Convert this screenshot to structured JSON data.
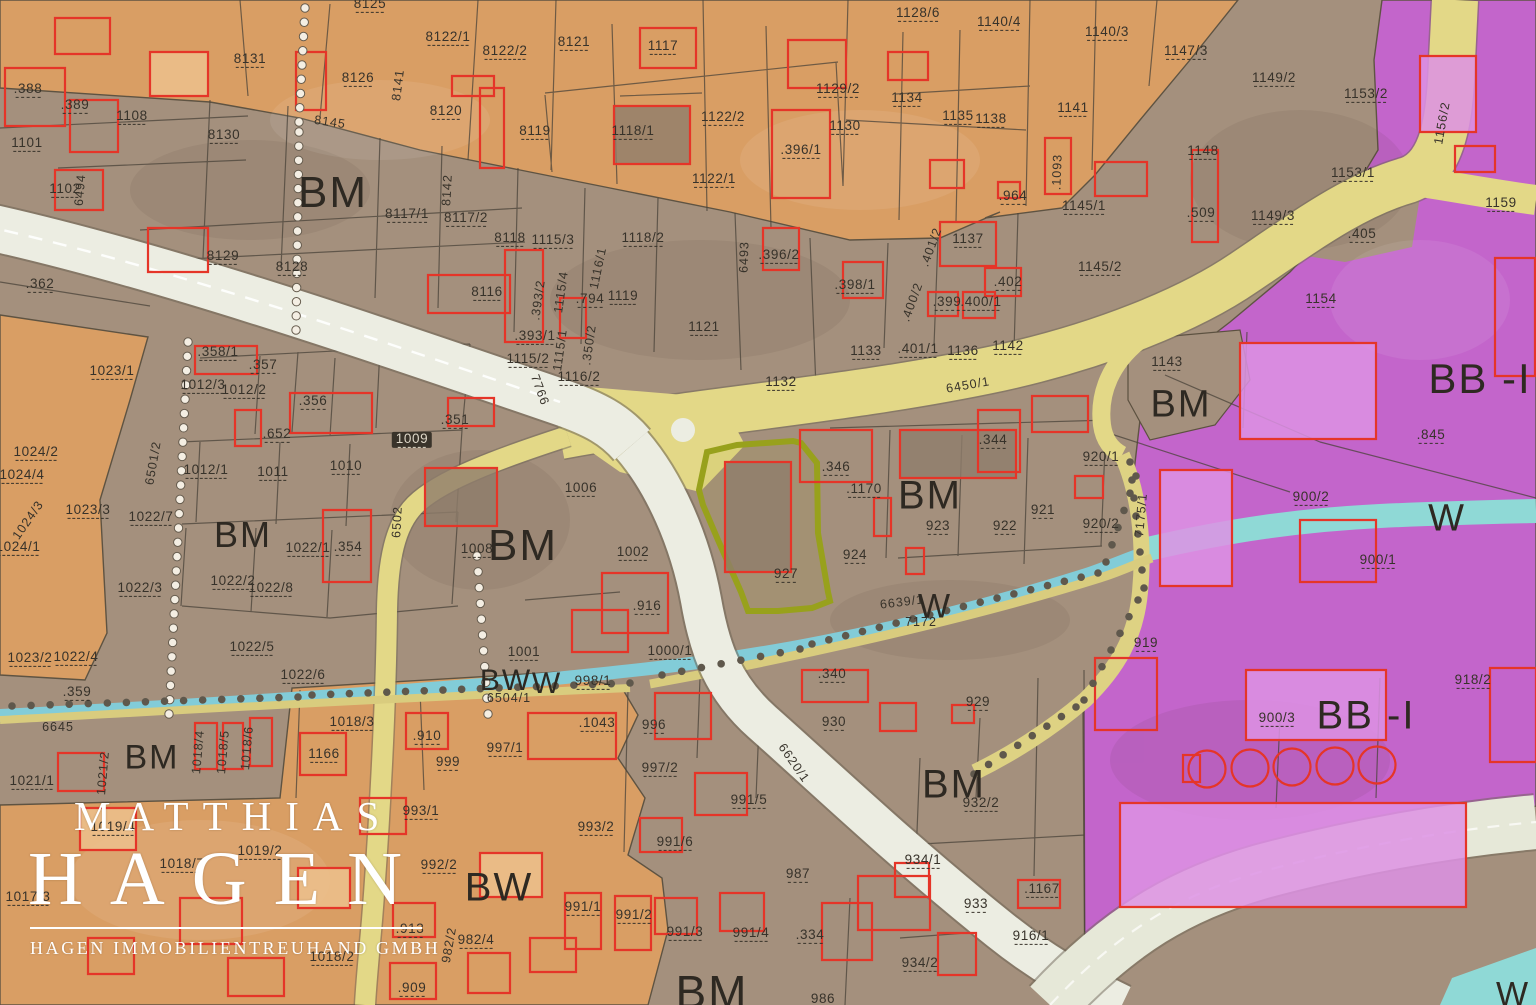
{
  "map": {
    "type": "zoning-cadastral-map",
    "zone_codes": [
      "BM",
      "BW",
      "W",
      "BB -I"
    ],
    "highlighted_parcel": "927",
    "colors": {
      "zone_mixed_brown": "#a4907d",
      "zone_residential_orange": "#dc9f63",
      "zone_industrial_purple": "#c563d0",
      "road_yellow": "#e3d887",
      "road_white": "#ecede2",
      "stream_blue": "#82ccd8",
      "stream_teal": "#8fd9d6",
      "building_outline_red": "#e53528",
      "highlight_olive": "#98a11c",
      "label_dark": "#37322a",
      "watermark_white": "#ffffff"
    }
  },
  "watermark": {
    "line1": "MATTHIAS",
    "line2": "HAGEN",
    "line3": "HAGEN IMMOBILIENTREUHAND GMBH"
  },
  "labels": {
    "zones": [
      {
        "t": "BM",
        "x": 333,
        "y": 193,
        "s": 44
      },
      {
        "t": "BM",
        "x": 243,
        "y": 535,
        "s": 36
      },
      {
        "t": "BM",
        "x": 523,
        "y": 546,
        "s": 44
      },
      {
        "t": "BM",
        "x": 930,
        "y": 496,
        "s": 40
      },
      {
        "t": "BM",
        "x": 1181,
        "y": 405,
        "s": 38
      },
      {
        "t": "BM",
        "x": 152,
        "y": 758,
        "s": 34
      },
      {
        "t": "BM",
        "x": 954,
        "y": 785,
        "s": 40
      },
      {
        "t": "BM",
        "x": 712,
        "y": 992,
        "s": 46
      },
      {
        "t": "BB -I",
        "x": 1480,
        "y": 379,
        "s": 42
      },
      {
        "t": "BB -I",
        "x": 1366,
        "y": 716,
        "s": 40
      },
      {
        "t": "BW",
        "x": 499,
        "y": 888,
        "s": 40
      },
      {
        "t": "BW",
        "x": 506,
        "y": 681,
        "s": 30
      },
      {
        "t": "W",
        "x": 547,
        "y": 684,
        "s": 30
      },
      {
        "t": "W",
        "x": 935,
        "y": 607,
        "s": 34
      },
      {
        "t": "W",
        "x": 1447,
        "y": 519,
        "s": 38
      },
      {
        "t": "W",
        "x": 1513,
        "y": 995,
        "s": 34
      }
    ],
    "parcels": [
      {
        "t": ".388",
        "x": 28,
        "y": 90
      },
      {
        "t": ".389",
        "x": 75,
        "y": 106
      },
      {
        "t": "1101",
        "x": 27,
        "y": 144
      },
      {
        "t": "1108",
        "x": 132,
        "y": 117
      },
      {
        "t": "8131",
        "x": 250,
        "y": 60
      },
      {
        "t": "8126",
        "x": 358,
        "y": 79
      },
      {
        "t": "8125",
        "x": 370,
        "y": 5
      },
      {
        "t": "8120",
        "x": 446,
        "y": 112
      },
      {
        "t": "8130",
        "x": 224,
        "y": 136
      },
      {
        "t": "8119",
        "x": 535,
        "y": 132
      },
      {
        "t": "8121",
        "x": 574,
        "y": 43
      },
      {
        "t": "8122/1",
        "x": 448,
        "y": 38
      },
      {
        "t": "8122/2",
        "x": 505,
        "y": 52
      },
      {
        "t": "1117",
        "x": 663,
        "y": 47
      },
      {
        "t": "1118/1",
        "x": 633,
        "y": 132
      },
      {
        "t": "1122/2",
        "x": 723,
        "y": 118
      },
      {
        "t": "1122/1",
        "x": 714,
        "y": 180
      },
      {
        "t": "1129/2",
        "x": 838,
        "y": 90
      },
      {
        "t": "1130",
        "x": 845,
        "y": 127
      },
      {
        "t": "1134",
        "x": 907,
        "y": 99
      },
      {
        "t": "1135",
        "x": 958,
        "y": 117
      },
      {
        "t": "1138",
        "x": 991,
        "y": 120
      },
      {
        "t": "1141",
        "x": 1073,
        "y": 109
      },
      {
        "t": "1128/6",
        "x": 918,
        "y": 14
      },
      {
        "t": "1140/4",
        "x": 999,
        "y": 23
      },
      {
        "t": "1140/3",
        "x": 1107,
        "y": 33
      },
      {
        "t": "1147/3",
        "x": 1186,
        "y": 52
      },
      {
        "t": "1149/2",
        "x": 1274,
        "y": 79
      },
      {
        "t": "1153/2",
        "x": 1366,
        "y": 95
      },
      {
        "t": "1153/1",
        "x": 1353,
        "y": 174
      },
      {
        "t": ".405",
        "x": 1362,
        "y": 235
      },
      {
        "t": "1148",
        "x": 1203,
        "y": 152
      },
      {
        "t": ".509",
        "x": 1201,
        "y": 214
      },
      {
        "t": "1149/3",
        "x": 1273,
        "y": 217
      },
      {
        "t": "1154",
        "x": 1321,
        "y": 300
      },
      {
        "t": "1159",
        "x": 1501,
        "y": 204
      },
      {
        "t": ".396/1",
        "x": 801,
        "y": 151
      },
      {
        "t": "1102",
        "x": 65,
        "y": 190
      },
      {
        "t": ".362",
        "x": 40,
        "y": 285
      },
      {
        "t": "8129",
        "x": 223,
        "y": 257
      },
      {
        "t": "8128",
        "x": 292,
        "y": 268
      },
      {
        "t": "8117/1",
        "x": 407,
        "y": 215
      },
      {
        "t": "8117/2",
        "x": 466,
        "y": 219
      },
      {
        "t": "8116",
        "x": 487,
        "y": 293
      },
      {
        "t": "8118",
        "x": 510,
        "y": 239
      },
      {
        "t": "1115/3",
        "x": 553,
        "y": 241
      },
      {
        "t": "1118/2",
        "x": 643,
        "y": 239
      },
      {
        "t": ".794",
        "x": 590,
        "y": 300
      },
      {
        "t": "1119",
        "x": 623,
        "y": 297
      },
      {
        "t": ".393/1",
        "x": 535,
        "y": 337
      },
      {
        "t": "1115/2",
        "x": 528,
        "y": 360
      },
      {
        "t": "1116/2",
        "x": 579,
        "y": 378
      },
      {
        "t": "1121",
        "x": 704,
        "y": 328
      },
      {
        "t": ".396/2",
        "x": 779,
        "y": 256
      },
      {
        "t": ".398/1",
        "x": 855,
        "y": 286
      },
      {
        "t": "1137",
        "x": 968,
        "y": 240
      },
      {
        "t": ".402",
        "x": 1008,
        "y": 283
      },
      {
        "t": ".399",
        "x": 947,
        "y": 303
      },
      {
        "t": ".400/1",
        "x": 981,
        "y": 303
      },
      {
        "t": ".401/1",
        "x": 918,
        "y": 350
      },
      {
        "t": "1136",
        "x": 963,
        "y": 352
      },
      {
        "t": "1142",
        "x": 1008,
        "y": 347
      },
      {
        "t": ".964",
        "x": 1013,
        "y": 197
      },
      {
        "t": "1145/1",
        "x": 1084,
        "y": 207
      },
      {
        "t": "1145/2",
        "x": 1100,
        "y": 268
      },
      {
        "t": "1133",
        "x": 866,
        "y": 352
      },
      {
        "t": "1132",
        "x": 781,
        "y": 383
      },
      {
        "t": "1143",
        "x": 1167,
        "y": 363
      },
      {
        "t": ".845",
        "x": 1431,
        "y": 436
      },
      {
        "t": "900/2",
        "x": 1311,
        "y": 498
      },
      {
        "t": "900/1",
        "x": 1378,
        "y": 561
      },
      {
        "t": "918/2",
        "x": 1473,
        "y": 681
      },
      {
        "t": "900/3",
        "x": 1277,
        "y": 719
      },
      {
        "t": "919",
        "x": 1146,
        "y": 644
      },
      {
        "t": "921",
        "x": 1043,
        "y": 511
      },
      {
        "t": "920/1",
        "x": 1101,
        "y": 458
      },
      {
        "t": "920/2",
        "x": 1101,
        "y": 525
      },
      {
        "t": ".344",
        "x": 993,
        "y": 441
      },
      {
        "t": ".346",
        "x": 836,
        "y": 468
      },
      {
        "t": ".1170",
        "x": 864,
        "y": 490
      },
      {
        "t": "923",
        "x": 938,
        "y": 527
      },
      {
        "t": "922",
        "x": 1005,
        "y": 527
      },
      {
        "t": "924",
        "x": 855,
        "y": 556
      },
      {
        "t": "927",
        "x": 786,
        "y": 575
      },
      {
        "t": ".351",
        "x": 455,
        "y": 421
      },
      {
        "t": ".356",
        "x": 313,
        "y": 402
      },
      {
        "t": ".357",
        "x": 263,
        "y": 366
      },
      {
        "t": ".358/1",
        "x": 218,
        "y": 353
      },
      {
        "t": "1012/3",
        "x": 203,
        "y": 386
      },
      {
        "t": "1012/2",
        "x": 244,
        "y": 391
      },
      {
        "t": ".652",
        "x": 277,
        "y": 435
      },
      {
        "t": "1012/1",
        "x": 206,
        "y": 471
      },
      {
        "t": "1011",
        "x": 273,
        "y": 473
      },
      {
        "t": "1010",
        "x": 346,
        "y": 467
      },
      {
        "t": "1009",
        "x": 412,
        "y": 440,
        "p": true
      },
      {
        "t": "1023/1",
        "x": 112,
        "y": 372
      },
      {
        "t": "1024/2",
        "x": 36,
        "y": 453
      },
      {
        "t": "1024/4",
        "x": 22,
        "y": 476
      },
      {
        "t": "1024/1",
        "x": 18,
        "y": 548
      },
      {
        "t": "1023/3",
        "x": 88,
        "y": 511
      },
      {
        "t": "1022/7",
        "x": 151,
        "y": 518
      },
      {
        "t": "1022/3",
        "x": 140,
        "y": 589
      },
      {
        "t": "1023/2",
        "x": 30,
        "y": 659
      },
      {
        "t": "1022/4",
        "x": 76,
        "y": 658
      },
      {
        "t": ".359",
        "x": 77,
        "y": 693
      },
      {
        "t": "1022/1",
        "x": 308,
        "y": 549
      },
      {
        "t": ".354",
        "x": 348,
        "y": 548
      },
      {
        "t": "1022/2",
        "x": 233,
        "y": 582
      },
      {
        "t": "1022/8",
        "x": 271,
        "y": 589
      },
      {
        "t": "1022/5",
        "x": 252,
        "y": 648
      },
      {
        "t": "1022/6",
        "x": 303,
        "y": 676
      },
      {
        "t": "1008",
        "x": 477,
        "y": 550
      },
      {
        "t": "1006",
        "x": 581,
        "y": 489
      },
      {
        "t": "1002",
        "x": 633,
        "y": 553
      },
      {
        "t": ".916",
        "x": 647,
        "y": 607
      },
      {
        "t": "1001",
        "x": 524,
        "y": 653
      },
      {
        "t": "1000/1",
        "x": 670,
        "y": 652
      },
      {
        "t": "998/1",
        "x": 593,
        "y": 682
      },
      {
        "t": "1018/3",
        "x": 352,
        "y": 723
      },
      {
        "t": "1021/1",
        "x": 32,
        "y": 782
      },
      {
        "t": "1166",
        "x": 324,
        "y": 755
      },
      {
        "t": ".910",
        "x": 427,
        "y": 737
      },
      {
        "t": "999",
        "x": 448,
        "y": 763
      },
      {
        "t": "997/1",
        "x": 505,
        "y": 749
      },
      {
        "t": ".1043",
        "x": 597,
        "y": 724
      },
      {
        "t": "996",
        "x": 654,
        "y": 726
      },
      {
        "t": "997/2",
        "x": 660,
        "y": 769
      },
      {
        "t": "991/5",
        "x": 749,
        "y": 801
      },
      {
        "t": "991/6",
        "x": 675,
        "y": 843
      },
      {
        "t": "993/2",
        "x": 596,
        "y": 828
      },
      {
        "t": "993/1",
        "x": 421,
        "y": 812
      },
      {
        "t": "992/2",
        "x": 439,
        "y": 866
      },
      {
        "t": ".913",
        "x": 410,
        "y": 930
      },
      {
        "t": "982/4",
        "x": 476,
        "y": 941
      },
      {
        "t": ".909",
        "x": 412,
        "y": 989
      },
      {
        "t": "1018/2",
        "x": 332,
        "y": 958
      },
      {
        "t": "1019/2",
        "x": 260,
        "y": 852
      },
      {
        "t": "1019/4",
        "x": 113,
        "y": 828
      },
      {
        "t": "1018/7",
        "x": 182,
        "y": 865
      },
      {
        "t": "1017/3",
        "x": 28,
        "y": 898
      },
      {
        "t": "991/1",
        "x": 583,
        "y": 908
      },
      {
        "t": "991/2",
        "x": 634,
        "y": 916
      },
      {
        "t": "991/3",
        "x": 685,
        "y": 933
      },
      {
        "t": "991/4",
        "x": 751,
        "y": 934
      },
      {
        "t": "987",
        "x": 798,
        "y": 875
      },
      {
        "t": ".334",
        "x": 810,
        "y": 936
      },
      {
        "t": ".340",
        "x": 832,
        "y": 675
      },
      {
        "t": "930",
        "x": 834,
        "y": 723
      },
      {
        "t": "929",
        "x": 978,
        "y": 703
      },
      {
        "t": "932/2",
        "x": 981,
        "y": 804
      },
      {
        "t": "934/1",
        "x": 923,
        "y": 861
      },
      {
        "t": "933",
        "x": 976,
        "y": 905
      },
      {
        "t": "934/2",
        "x": 920,
        "y": 964
      },
      {
        "t": "986",
        "x": 823,
        "y": 1000
      },
      {
        "t": ".1167",
        "x": 1042,
        "y": 890
      },
      {
        "t": "916/1",
        "x": 1031,
        "y": 937
      }
    ],
    "roads": [
      {
        "t": "8141",
        "x": 398,
        "y": 85,
        "r": -83
      },
      {
        "t": "8142",
        "x": 447,
        "y": 190,
        "r": -87
      },
      {
        "t": "8145",
        "x": 330,
        "y": 122,
        "r": 8
      },
      {
        "t": "6494",
        "x": 80,
        "y": 190,
        "r": -85
      },
      {
        "t": "6493",
        "x": 744,
        "y": 257,
        "r": -88
      },
      {
        "t": "7766",
        "x": 540,
        "y": 390,
        "r": 70
      },
      {
        "t": "6502",
        "x": 397,
        "y": 522,
        "r": -87
      },
      {
        "t": "6501/2",
        "x": 153,
        "y": 463,
        "r": -80
      },
      {
        "t": "6450/1",
        "x": 968,
        "y": 385,
        "r": -10
      },
      {
        "t": "6639/1",
        "x": 902,
        "y": 602,
        "r": -7
      },
      {
        "t": "6620/1",
        "x": 794,
        "y": 763,
        "r": 55
      },
      {
        "t": "6645",
        "x": 58,
        "y": 727,
        "r": 0
      },
      {
        "t": "6504/1",
        "x": 509,
        "y": 698,
        "r": 0
      },
      {
        "t": "1156/2",
        "x": 1442,
        "y": 123,
        "r": -80
      },
      {
        "t": "7175/1",
        "x": 1141,
        "y": 515,
        "r": -85
      },
      {
        "t": "7172",
        "x": 921,
        "y": 622,
        "r": 0
      },
      {
        "t": ".1093",
        "x": 1057,
        "y": 172,
        "r": -88
      },
      {
        "t": ".401/2",
        "x": 931,
        "y": 247,
        "r": -70
      },
      {
        "t": ".400/2",
        "x": 912,
        "y": 302,
        "r": -70
      },
      {
        "t": ".393/2",
        "x": 538,
        "y": 300,
        "r": -82
      },
      {
        "t": "1115/4",
        "x": 561,
        "y": 292,
        "r": -82
      },
      {
        "t": "1116/1",
        "x": 598,
        "y": 268,
        "r": -78
      },
      {
        "t": "1115/1",
        "x": 560,
        "y": 350,
        "r": -82
      },
      {
        "t": ".350/2",
        "x": 589,
        "y": 345,
        "r": -82
      },
      {
        "t": "1021/2",
        "x": 103,
        "y": 773,
        "r": -85
      },
      {
        "t": "1018/4",
        "x": 198,
        "y": 752,
        "r": -85
      },
      {
        "t": "1018/5",
        "x": 223,
        "y": 752,
        "r": -85
      },
      {
        "t": "1018/6",
        "x": 247,
        "y": 748,
        "r": -85
      },
      {
        "t": "982/2",
        "x": 449,
        "y": 945,
        "r": -80
      },
      {
        "t": "1024/3",
        "x": 28,
        "y": 520,
        "r": -55
      }
    ]
  }
}
